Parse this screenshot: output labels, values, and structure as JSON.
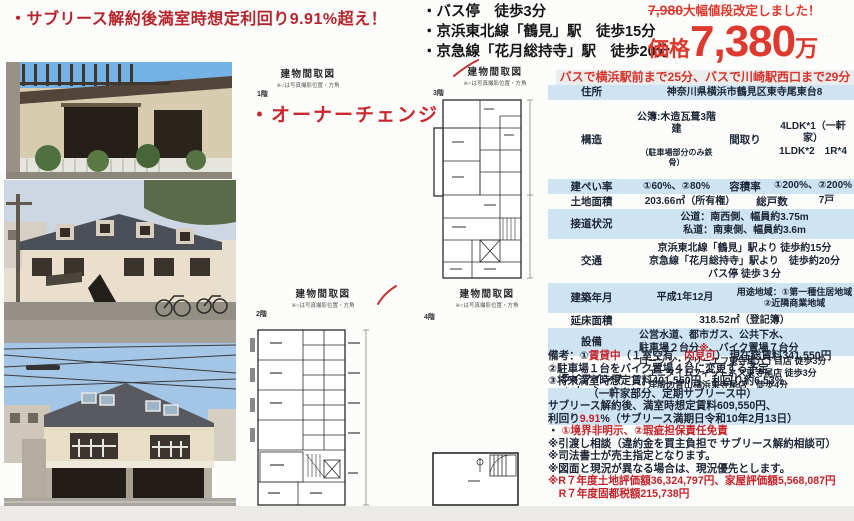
{
  "headline": "・サブリース解約後満室時想定利回り9.91%超え！",
  "owner_change": "・オーナーチェンジ",
  "access": {
    "items": [
      "・バス停　徒歩3分",
      "・京浜東北線「鶴見」駅　徒歩15分",
      "・京急線「花月総持寺」駅　徒歩20分"
    ]
  },
  "price": {
    "old_price": "7,980",
    "notice": "大幅値段改定しました！",
    "label": "価格",
    "value": "7,380",
    "unit": "万"
  },
  "bus_banner": "バスで横浜駅前まで25分、バスで川崎駅西口まで29分",
  "floorplan": {
    "title": "建物間取図",
    "subtitle": "※○は写真撮影位置・方角",
    "floor1": "1階",
    "floor2": "2階",
    "floor3": "3階",
    "floor4": "4階"
  },
  "table": {
    "r0": {
      "label": "住所",
      "value": "神奈川県横浜市鶴見区東寺尾東台8"
    },
    "r1": {
      "label": "構造",
      "value_main": "公簿:木造瓦葺3階建",
      "value_sub": "（駐車場部分のみ鉄骨）",
      "label2": "間取り",
      "value2": "4LDK*1（一軒家）\n1LDK*2　1R*4"
    },
    "r2": {
      "label": "建ぺい率",
      "value": "①60%、②80%",
      "label2": "容積率",
      "value2": "①200%、②200%"
    },
    "r3": {
      "label": "土地面積",
      "value": "203.66㎡（所有権）",
      "label2": "総戸数",
      "value2": "7戸"
    },
    "r4": {
      "label": "接道状況",
      "value": "公道：南西側、幅員約3.75m\n私道：南東側、幅員約3.6m"
    },
    "r5": {
      "label": "交通",
      "value": "京浜東北線「鶴見」駅より 徒歩約15分\n京急線「花月総持寺」駅より　徒歩約20分\nバス停 徒歩３分"
    },
    "r6": {
      "label": "建築年月",
      "value": "平成1年12月",
      "value2": "用途地域：①第一種住居地域\n②近隣商業地域"
    },
    "r7": {
      "label": "延床面積",
      "value": "318.52㎡（登記簿）"
    },
    "r8": {
      "label": "設備",
      "value_a": "公営水道、都市ガス、公共下水、\n駐車場２台分",
      "value_red": "※",
      "value_b": "、バイク置場７台分"
    },
    "r9": {
      "label": "ライフインフ\nォメーション",
      "value": "ローソン・スリーエフ東寺尾六丁目店 徒歩3分\n・エニタイムフィットネス東寺尾店 徒歩3分\n・洋服の青山横浜東寺尾店　徒歩4分\n・横浜市立東台小学校 徒歩4分）\n・ツルハドラッグ横浜東寺尾店　徒歩7分"
    }
  },
  "remarks": {
    "l0a": "備考：①",
    "l0b": "賃貸中",
    "l0c": "（１室空有、",
    "l0d": "内見可",
    "l0e": "） 現在総賃料341,550円",
    "l1": "②駐車場１台をバイク置場４台に変更する予定",
    "l2": "③将来満室時想定賃料401,550円、利回り約6.53%",
    "l3": "（一軒家部分、定期サブリース中）",
    "l4": "サブリース解約後、満室時想定賃料609,550円、",
    "l5a": "利回り",
    "l5b": "9.91",
    "l5c": "%（サブリース満期日令和10年2月13日）",
    "l6a": "・ ",
    "l6b": "①境界非明示、②瑕疵担保責任免責",
    "l7": "※引渡し相談（違約金を買主負担で サブリース解約相談可）",
    "l8": "※司法書士が売主指定となります。",
    "l9": "※図面と現況が異なる場合は、現況優先とします。",
    "l10": "※R７年度土地評価額36,324,797円、家屋評価額5,568,087円",
    "l11": "　R７年度固都税額215,738円"
  },
  "colors": {
    "accent_red": "#c4232a",
    "price_red": "#dd392e",
    "table_blue": "#cfe4f2"
  }
}
